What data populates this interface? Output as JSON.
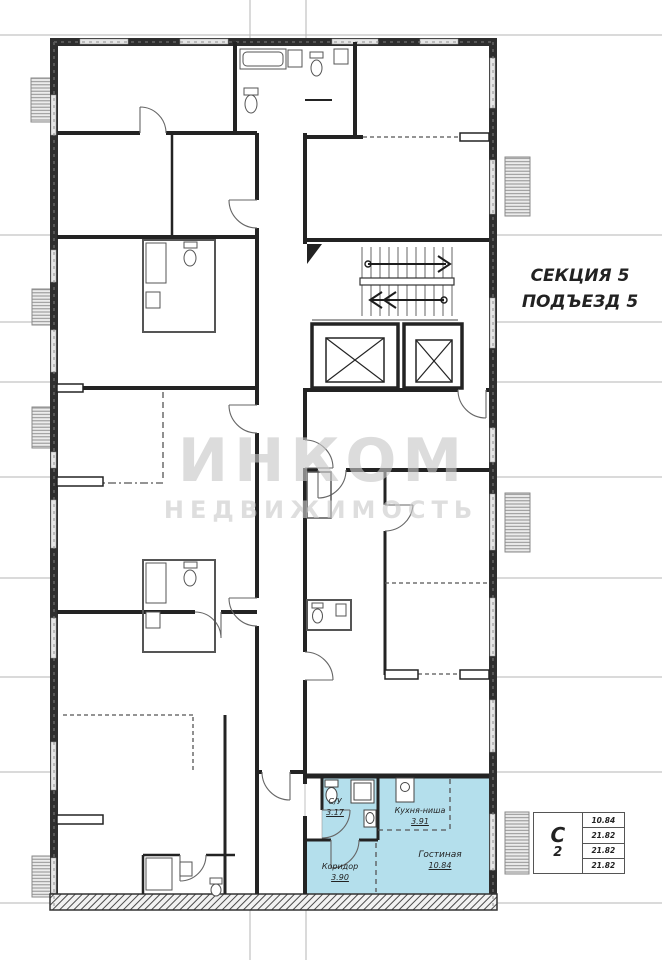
{
  "header": {
    "section_label": "СЕКЦИЯ 5",
    "entrance_label": "ПОДЪЕЗД 5"
  },
  "watermark": {
    "brand": "ИНКОМ",
    "tagline": "НЕДВИЖИМОСТЬ"
  },
  "highlighted_unit": {
    "highlight_color": "#b4dfec",
    "rooms": [
      {
        "name": "С/У",
        "area": "3.17"
      },
      {
        "name": "Кухня-ниша",
        "area": "3.91"
      },
      {
        "name": "Гостиная",
        "area": "10.84"
      },
      {
        "name": "Коридор",
        "area": "3.90"
      }
    ]
  },
  "info_table": {
    "unit_type": "С",
    "unit_number": "2",
    "areas": [
      "10.84",
      "21.82",
      "21.82",
      "21.82"
    ]
  }
}
